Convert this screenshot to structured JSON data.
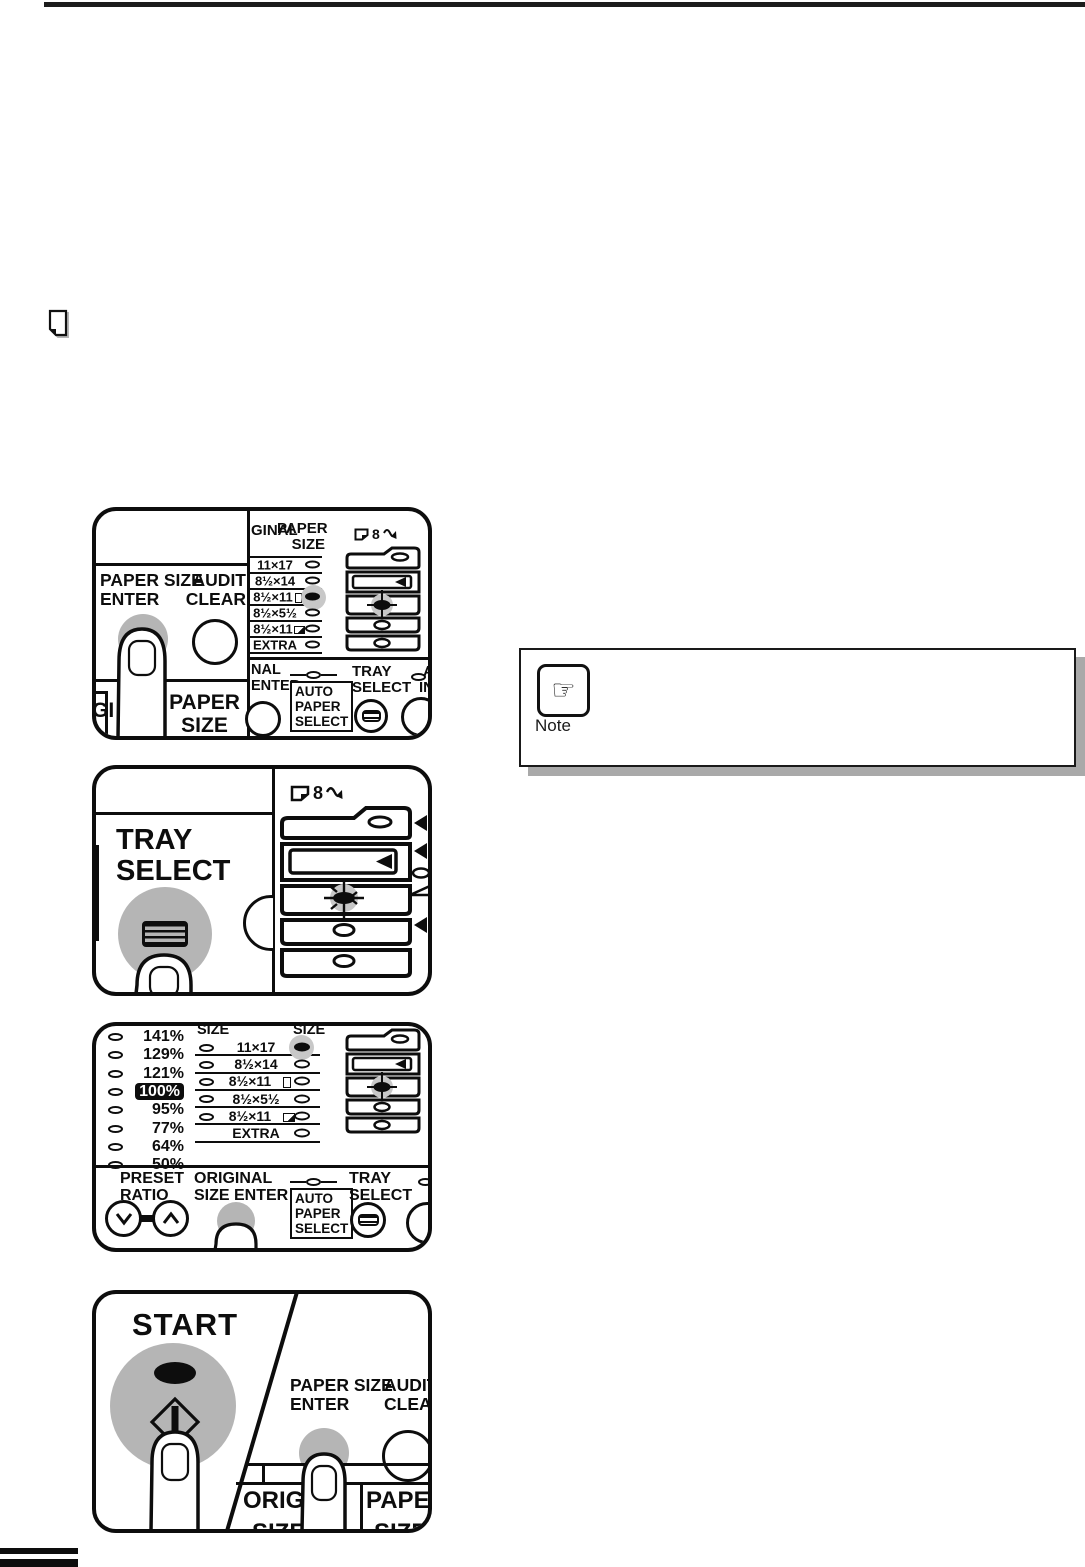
{
  "note": {
    "label": "Note"
  },
  "p1": {
    "paper_size_enter": "PAPER SIZE\nENTER",
    "audit_clear": "AUDIT\nCLEAR",
    "cut_gi": "GI",
    "cut_paper_size": "PAPER\nSIZE",
    "cut_ginal": "GINAL",
    "col_paper_size": "PAPER\nSIZE",
    "sizes": [
      "11×17",
      "8½×14",
      "8½×11",
      "8½×5½",
      "8½×11",
      "EXTRA"
    ],
    "misfeed": "8",
    "cut_nal_enter": "NAL\nENTER",
    "auto_paper_select": "AUTO\nPAPER\nSELECT",
    "tray_select": "TRAY\nSELECT",
    "cut_a": "A",
    "cut_in": "IN"
  },
  "p2": {
    "tray_select": "TRAY\nSELECT",
    "misfeed": "8"
  },
  "p3": {
    "ratios": [
      "141%",
      "129%",
      "121%",
      "100%",
      "95%",
      "77%",
      "64%",
      "50%"
    ],
    "selected_ratio": "100%",
    "size_col_left": "SIZE",
    "size_col_right": "SIZE",
    "sizes": [
      "11×17",
      "8½×14",
      "8½×11",
      "8½×5½",
      "8½×11",
      "EXTRA"
    ],
    "preset_ratio": "PRESET\nRATIO",
    "original_size_enter": "ORIGINAL\nSIZE ENTER",
    "auto_paper_select": "AUTO\nPAPER\nSELECT",
    "tray_select": "TRAY\nSELECT"
  },
  "p4": {
    "start": "START",
    "paper_size_enter": "PAPER SIZE\nENTER",
    "audit_clear": "AUDIT\nCLEAR",
    "cut_origi": "ORIGI",
    "cut_paper": "PAPER",
    "cut_size_a": "SIZE",
    "cut_size_b": "SIZE"
  },
  "colors": {
    "button_gray": "#b5b5b5",
    "led_halo": "#c8c8c8",
    "box_shadow": "#a9a9a9"
  }
}
